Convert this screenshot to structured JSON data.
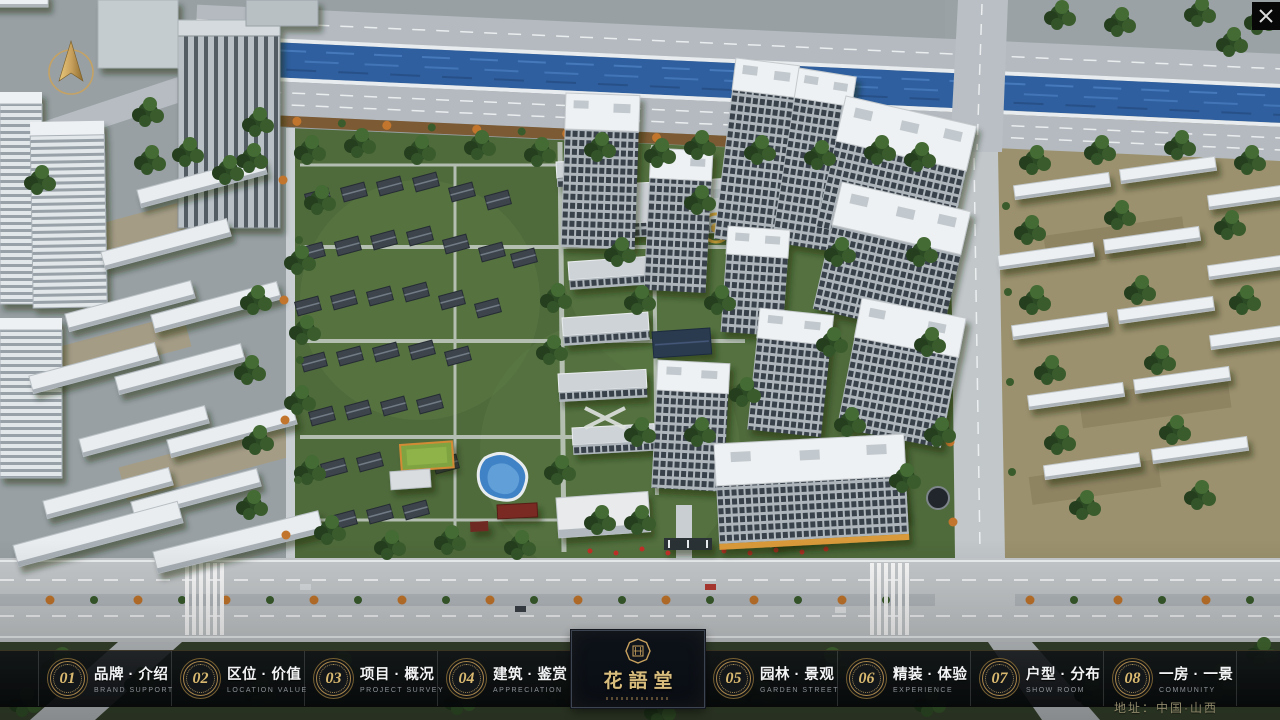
{
  "window": {
    "close_glyph": "✕"
  },
  "nav": {
    "items": [
      {
        "number": "01",
        "label": "品牌 · 介绍",
        "sublabel": "BRAND SUPPORT"
      },
      {
        "number": "02",
        "label": "区位 · 价值",
        "sublabel": "LOCATION VALUE"
      },
      {
        "number": "03",
        "label": "项目 · 概况",
        "sublabel": "PROJECT SURVEY"
      },
      {
        "number": "04",
        "label": "建筑 · 鉴赏",
        "sublabel": "APPRECIATION"
      },
      {
        "number": "05",
        "label": "园林 · 景观",
        "sublabel": "GARDEN STREET"
      },
      {
        "number": "06",
        "label": "精装 · 体验",
        "sublabel": "EXPERIENCE"
      },
      {
        "number": "07",
        "label": "户型 · 分布",
        "sublabel": "SHOW ROOM"
      },
      {
        "number": "08",
        "label": "一房 · 一景",
        "sublabel": "COMMUNITY"
      }
    ]
  },
  "logo": {
    "title": "花語堂"
  },
  "footer": {
    "address": "地址：中国·山西"
  },
  "icons": {
    "compass": "north-arrow",
    "seal": "brand-seal"
  },
  "colors": {
    "gold": "#c9a25e",
    "bar_bg": "#0a0d10",
    "river": "#2f5f9e",
    "greenery": "#4f6a3b",
    "road": "#c6cacc"
  }
}
